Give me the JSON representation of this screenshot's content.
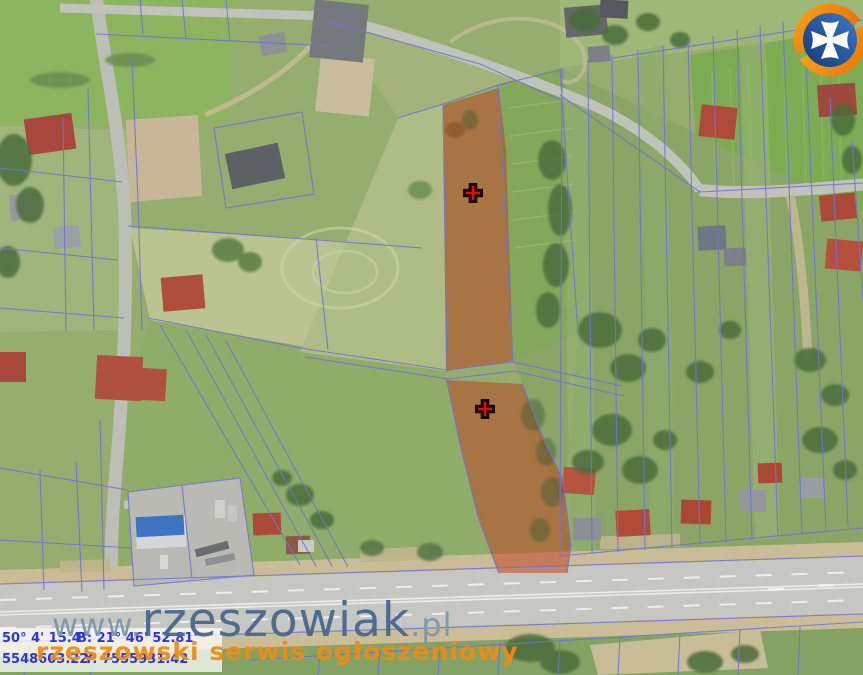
{
  "map": {
    "markers": [
      {
        "transform": "translate(473,193)"
      },
      {
        "transform": "translate(485,409)"
      }
    ],
    "highlight_parcels": [
      {
        "points": "443,105 499,88 506,150 513,361 446,371"
      },
      {
        "points": "446,380 522,384 544,440 563,480 571,545 567,573 498,573 478,517 459,440"
      }
    ],
    "colors": {
      "parcel_fill": "#c03714",
      "parcel_opacity": "0.48",
      "cadastral_line": "#7272d8",
      "marker_fill": "#d81111",
      "marker_stroke": "#1c0402"
    }
  },
  "watermark": {
    "prefix": "www.",
    "brand": "rzeszowiak",
    "suffix": ".pl",
    "tagline": "rzeszowski serwis ogłoszeniowy"
  },
  "coordinates": {
    "line1_left": "50° 4' 15.4\"",
    "line1_right": "B: 21° 46' 52.81\"",
    "line2_left": "5548603.22",
    "line2_right": "Y: 7555931.42"
  }
}
